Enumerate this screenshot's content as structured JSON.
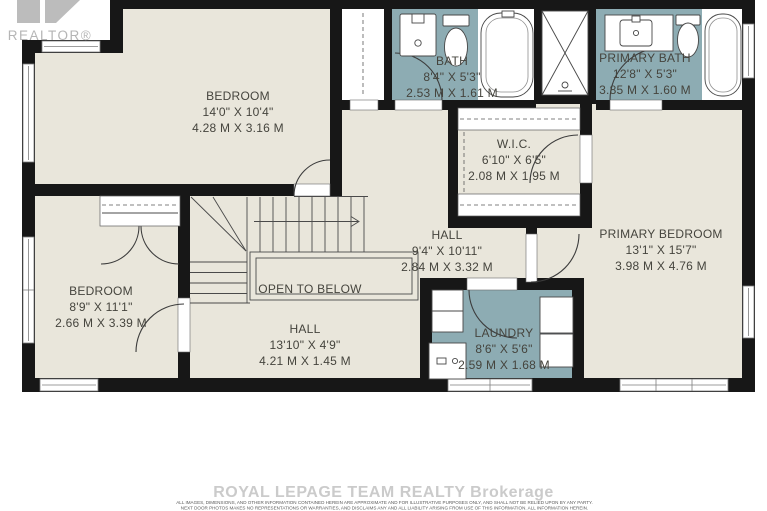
{
  "branding": {
    "logo_text": "REALTOR®",
    "watermark": "ROYAL LEPAGE TEAM REALTY Brokerage",
    "disclaimer_line1": "ALL IMAGES, DIMENSIONS, AND OTHER INFORMATION CONTAINED HEREIN ARE APPROXIMATE AND FOR ILLUSTRATIVE PURPOSES ONLY, AND SHALL NOT BE RELIED UPON BY ANY PARTY.",
    "disclaimer_line2": "NEXT DOOR PHOTOS MAKES NO REPRESENTATIONS OR WARRANTIES, AND DISCLAIMS ANY AND ALL LIABILITY ARISING FROM USE OF THIS INFORMATION. ALL INFORMATION HEREIN."
  },
  "colors": {
    "wall": "#171717",
    "floor": "#e9e6db",
    "wet_room": "#8dacb3",
    "label_text": "#45443d",
    "logo_gray": "#b5b5b5",
    "watermark_gray": "#cbcbcb"
  },
  "rooms": {
    "bedroom_top": {
      "name": "BEDROOM",
      "imperial": "14'0\" X 10'4\"",
      "metric": "4.28 M X 3.16 M"
    },
    "bath": {
      "name": "BATH",
      "imperial": "8'4\" X 5'3\"",
      "metric": "2.53 M X 1.61 M"
    },
    "primary_bath": {
      "name": "PRIMARY BATH",
      "imperial": "12'8\" X 5'3\"",
      "metric": "3.85 M X 1.60 M"
    },
    "wic": {
      "name": "W.I.C.",
      "imperial": "6'10\" X 6'5\"",
      "metric": "2.08 M X 1.95 M"
    },
    "hall_upper": {
      "name": "HALL",
      "imperial": "9'4\" X 10'11\"",
      "metric": "2.84 M X 3.32 M"
    },
    "primary_bedroom": {
      "name": "PRIMARY BEDROOM",
      "imperial": "13'1\" X 15'7\"",
      "metric": "3.98 M X 4.76 M"
    },
    "bedroom_left": {
      "name": "BEDROOM",
      "imperial": "8'9\" X 11'1\"",
      "metric": "2.66 M X 3.39 M"
    },
    "hall_lower": {
      "name": "HALL",
      "imperial": "13'10\" X 4'9\"",
      "metric": "4.21 M X 1.45 M"
    },
    "laundry": {
      "name": "LAUNDRY",
      "imperial": "8'6\" X 5'6\"",
      "metric": "2.59 M X 1.68 M"
    },
    "open_to_below": {
      "name": "OPEN TO BELOW"
    }
  }
}
